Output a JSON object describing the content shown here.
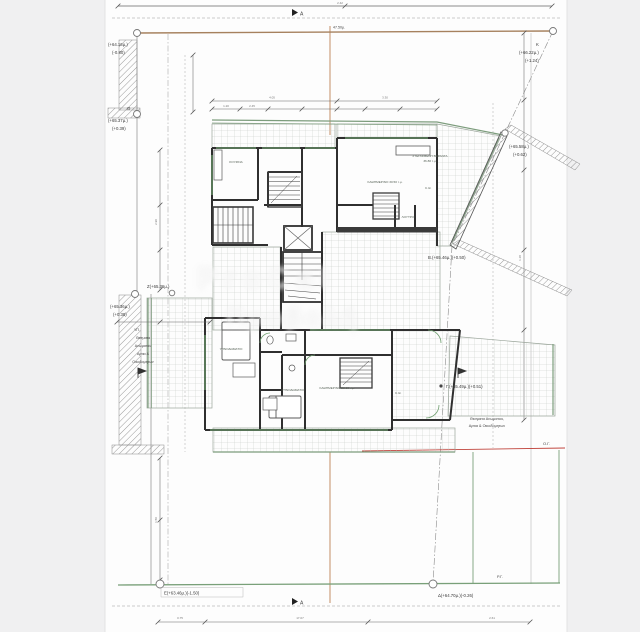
{
  "palette": {
    "paper": "#fdfdfd",
    "page_bg": "#f0f0f1",
    "wall": "#2f2f2f",
    "green": "#6f9e6f",
    "terrace_green": "#7d9d7d",
    "boundary_brown": "#a6815e",
    "red": "#c0443c",
    "dim": "#666666"
  },
  "section_marker": "A",
  "survey": {
    "corner_a": {
      "l1": "(+64.16μ.)",
      "l2": "(-0.80)"
    },
    "theta": {
      "name": "Θ",
      "l1": "(+65.37μ.)",
      "l2": "(+0.39)"
    },
    "z": {
      "label": "Ζ(+65.36μ.)",
      "l1": "(+65.36μ.)",
      "l2": "(+0.38)"
    },
    "k": {
      "name": "Κ",
      "l1": "(+66.22μ.)",
      "l2": "(+1.24)"
    },
    "slant": {
      "l1": "(+65.58μ.)",
      "l2": "(+0.62)"
    },
    "beta": {
      "label": "Β.(+65.46μ.)(+0.50)"
    },
    "gamma": {
      "label": "Γ.(+65.49μ.)(+0.51)"
    },
    "e": {
      "label": "Ε(+63.46μ.)(-1.50)"
    },
    "delta": {
      "label": "Δ(+64.70μ.)(-0.26)"
    }
  },
  "boundary_notes": {
    "left": {
      "l0": "ΥΠ.",
      "l1": "Θεσματα",
      "l2": "Ανωματου",
      "l3": "Αρτια &",
      "l4": "Οικοδομητων"
    },
    "right": {
      "l1": "Θεσματα Ανωματου,",
      "l2": "Αρτια & Οικοδομητων"
    }
  },
  "line_labels": {
    "og": "Ο.Γ.",
    "rg": "Ρ.Γ.",
    "boundary_dim": "47.50μ."
  },
  "rooms": {
    "up_terrace_1": "ΣΤΕΓΑΣΜΕΝΗ ΒΕΡΑΝΤΑ",
    "up_terrace_2": "36.80 τ.μ.",
    "up_living": "ΚΑΘΗΜΕΡΙΝΟ 30.50 τ.μ.",
    "up_kitchen": "ΚΟΥΖΙΝΑ",
    "up_bath": "ΛΟΥΤΡΟ",
    "low_living": "ΚΑΘΗΜΕΡΙΝΟ 28.60 τ.μ.",
    "low_bed1": "ΥΠΝΟΔΩΜΑΤΙΟ",
    "low_bed2": "ΥΠΝΟΔΩΜΑΤΙΟ",
    "ct1": "C.Θ.",
    "ct2": "C.Θ."
  },
  "dims": {
    "top": "2.42",
    "a1": "4.05",
    "a2": "3.30",
    "a3": "1.20",
    "a4": "2.45",
    "v1": "2.90",
    "v2": "1.50",
    "r1": "1.18",
    "b1": "0.75",
    "b2": "17.07",
    "b3": "2.61"
  },
  "watermark": {
    "line1": "ProCal",
    "line2": "Προβολή"
  }
}
